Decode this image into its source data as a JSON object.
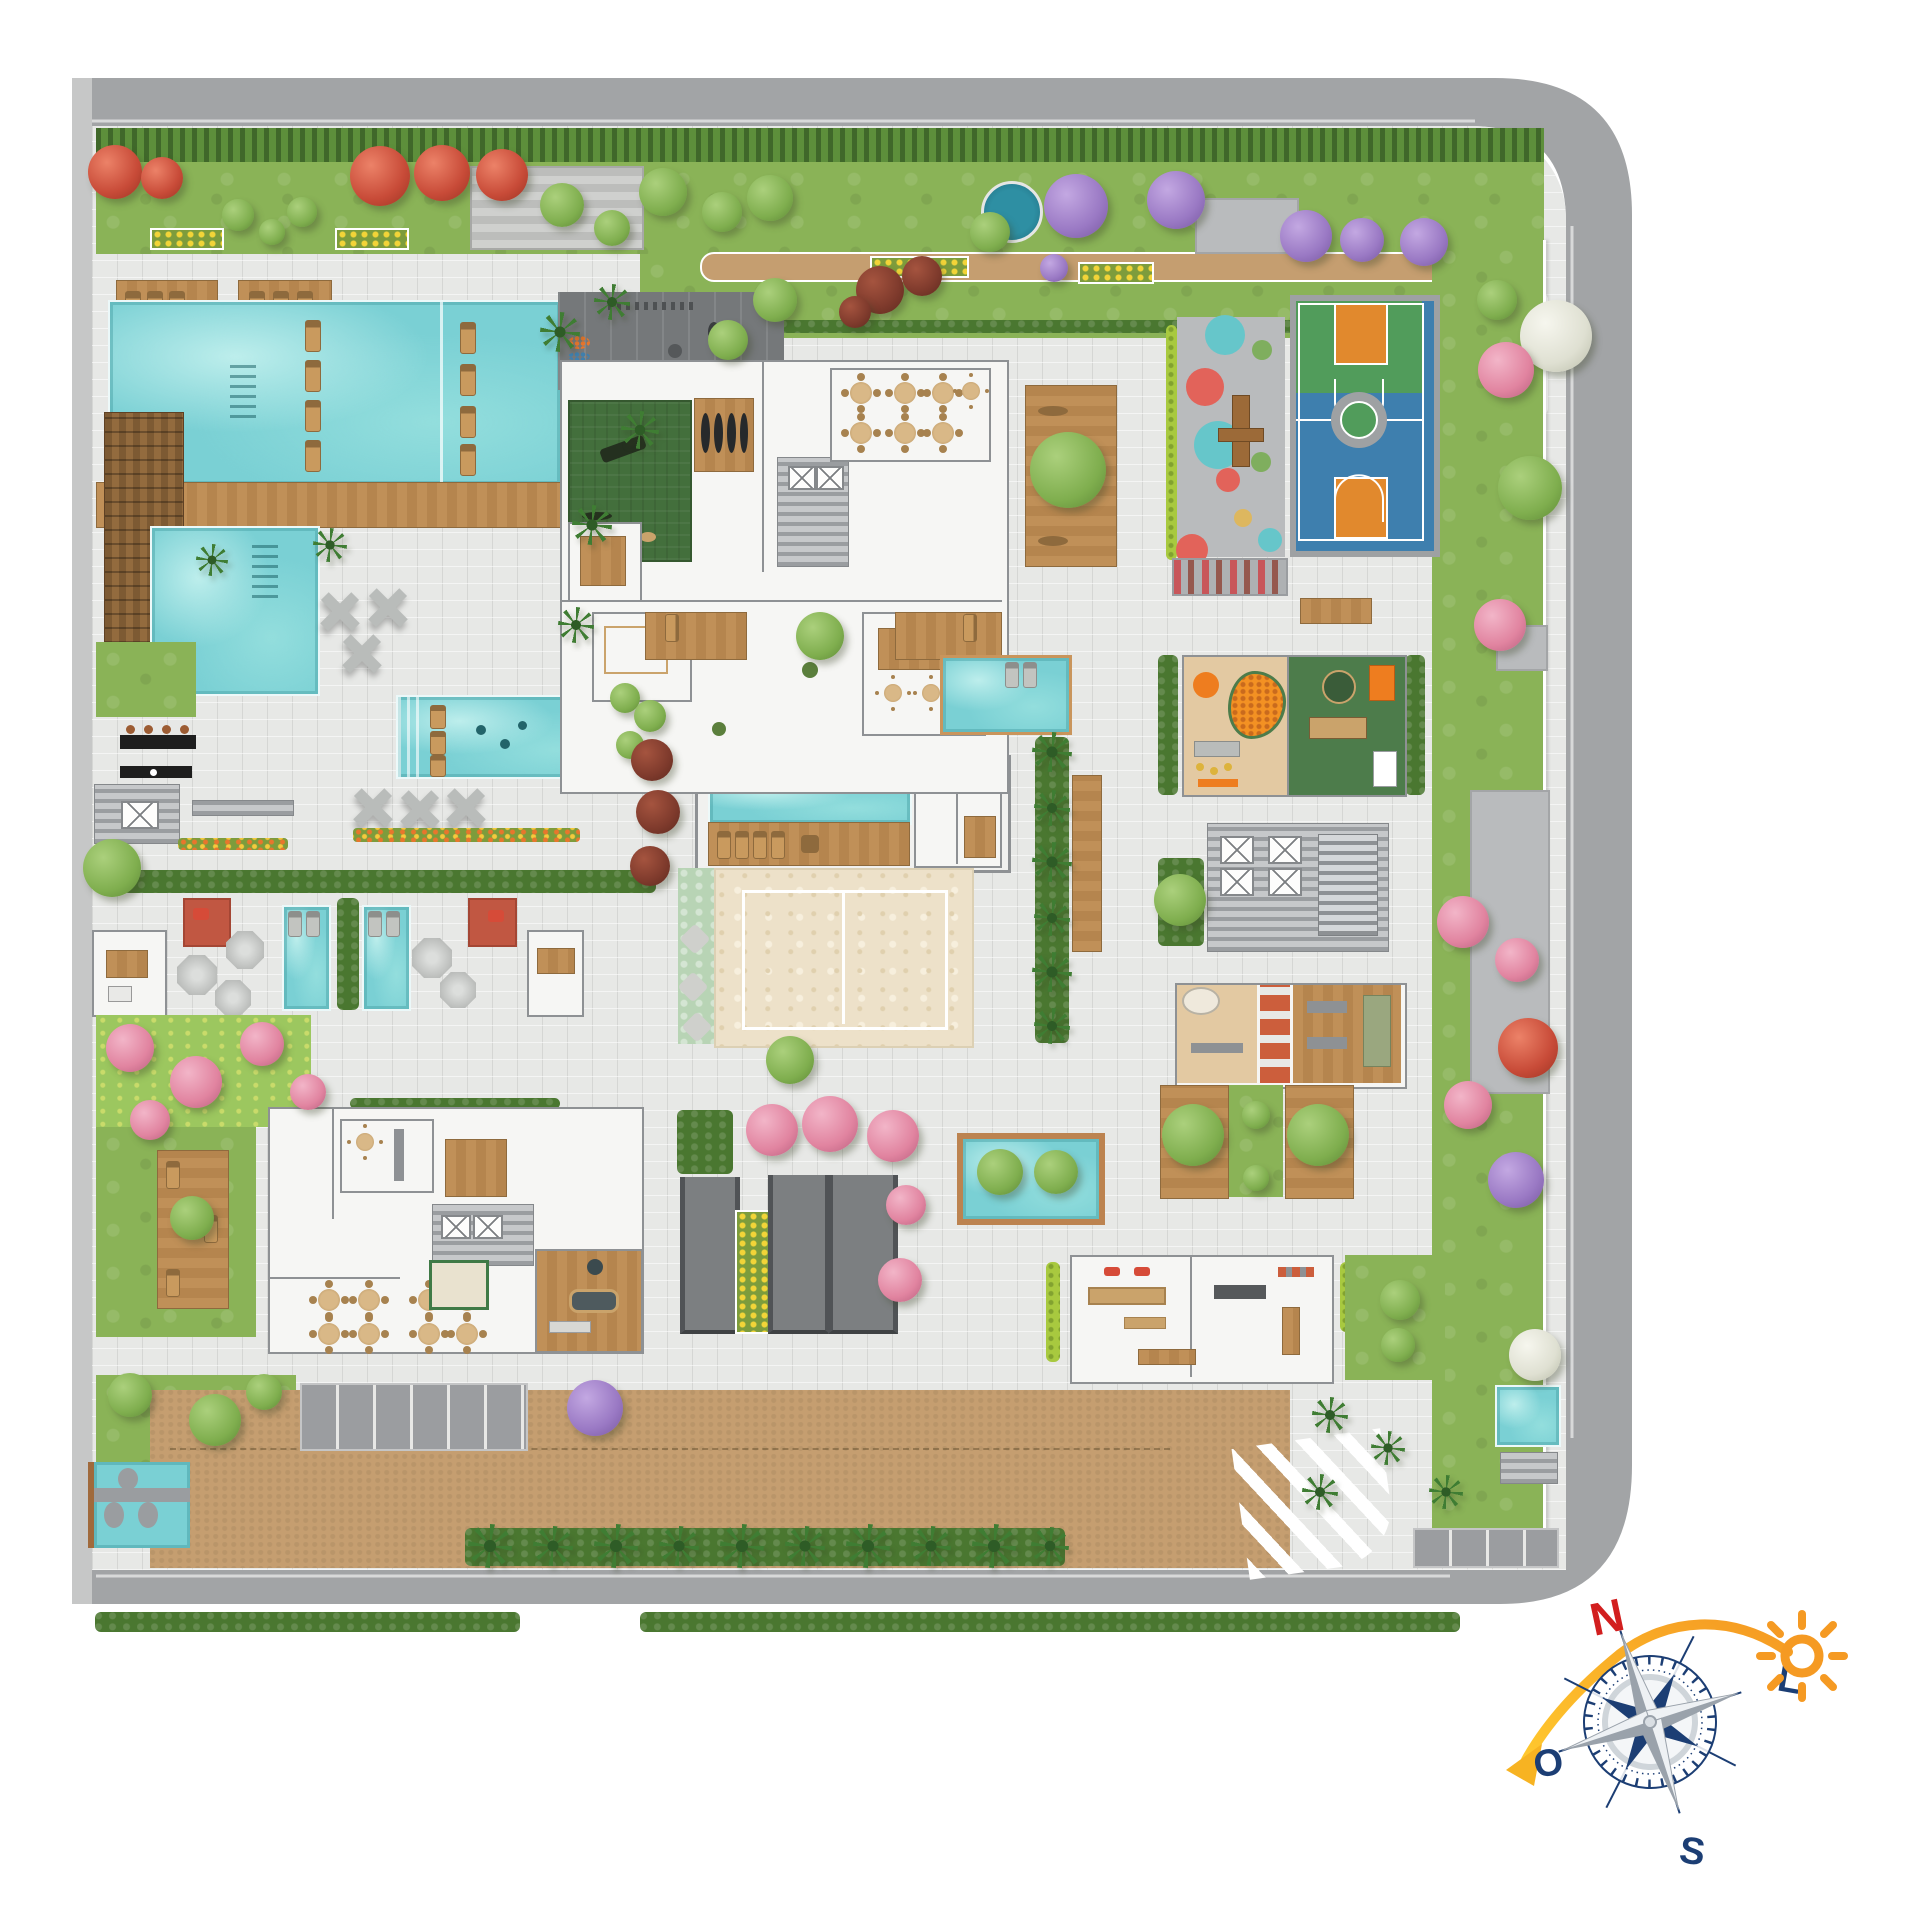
{
  "compass": {
    "north": "N",
    "east": "L",
    "south": "S",
    "west": "O"
  },
  "palette": {
    "road": "#a2a4a6",
    "roadlight": "#c6c7c7",
    "curb": "#d8d9d9",
    "paving": "#e7e8e6",
    "lawn": "#8ab357",
    "hedge": "#4a7730",
    "water": "#7ad0d4",
    "wood": "#b9854f",
    "sand": "#ede1c9",
    "drive": "#c59e70",
    "courtblue": "#3e7fae",
    "courtgreen": "#519c5b",
    "courtorange": "#e1892d",
    "service": "#75787a",
    "room": "#f6f6f4",
    "wall": "#8e9194",
    "turf": "#436f3c",
    "playground": "#b9bbbd",
    "matred": "#c15742",
    "navy": "#1c3e74",
    "northred": "#d21f1f",
    "sun": "#f59a23",
    "gold": "#f5b81e"
  },
  "areas": [
    {
      "name": "perimeter-road",
      "color": "#a2a4a6"
    },
    {
      "name": "perimeter-hedge",
      "color": "#4a7730"
    },
    {
      "name": "north-garden-lawn",
      "color": "#8ab357"
    },
    {
      "name": "garden-path",
      "color": "#c9a173"
    },
    {
      "name": "kids-splash-circle",
      "color": "#2e8fa3"
    },
    {
      "name": "main-pool-upper",
      "color": "#7ad0d4"
    },
    {
      "name": "main-pool-lower",
      "color": "#7ad0d4"
    },
    {
      "name": "pool-wood-bridge",
      "color": "#b9854f"
    },
    {
      "name": "wood-trellis-deck",
      "color": "#7d5a33"
    },
    {
      "name": "family-pool",
      "color": "#7ad0d4"
    },
    {
      "name": "bbq-counter",
      "color": "#222222"
    },
    {
      "name": "spa-suites",
      "color": "#f6f6f4"
    },
    {
      "name": "plunge-pools",
      "color": "#7ad0d4"
    },
    {
      "name": "lap-pool-pavilion",
      "color": "#7ad0d4"
    },
    {
      "name": "beach-volleyball-court",
      "color": "#ede1c9"
    },
    {
      "name": "amenity-building-north",
      "color": "#f6f6f4"
    },
    {
      "name": "gym-turf",
      "color": "#436f3c"
    },
    {
      "name": "service-yard",
      "color": "#75787a"
    },
    {
      "name": "playground",
      "color": "#b9bbbd"
    },
    {
      "name": "basketball-court",
      "color": "#3e7fae"
    },
    {
      "name": "amenity-building-east",
      "color": "#f6f6f4"
    },
    {
      "name": "kids-ball-pit-room",
      "color": "#f39123"
    },
    {
      "name": "games-room",
      "color": "#4d7c4b"
    },
    {
      "name": "coworking-rooms",
      "color": "#f6f6f4"
    },
    {
      "name": "tree-island-pool",
      "color": "#7ad0d4"
    },
    {
      "name": "amenity-building-south",
      "color": "#f6f6f4"
    },
    {
      "name": "billiards-room",
      "color": "#b9854f"
    },
    {
      "name": "wellness-building",
      "color": "#f6f6f4"
    },
    {
      "name": "garage-ramps",
      "color": "#7c7f81"
    },
    {
      "name": "entrance-driveway",
      "color": "#c59e70"
    },
    {
      "name": "parking-bays",
      "color": "#9b9da0"
    },
    {
      "name": "crosswalk",
      "color": "#ffffff"
    },
    {
      "name": "palm-promenade",
      "color": "#3f7d33"
    },
    {
      "name": "compass-rose",
      "color": "#1c3e74"
    },
    {
      "name": "sun-icon",
      "color": "#f59a23"
    }
  ]
}
